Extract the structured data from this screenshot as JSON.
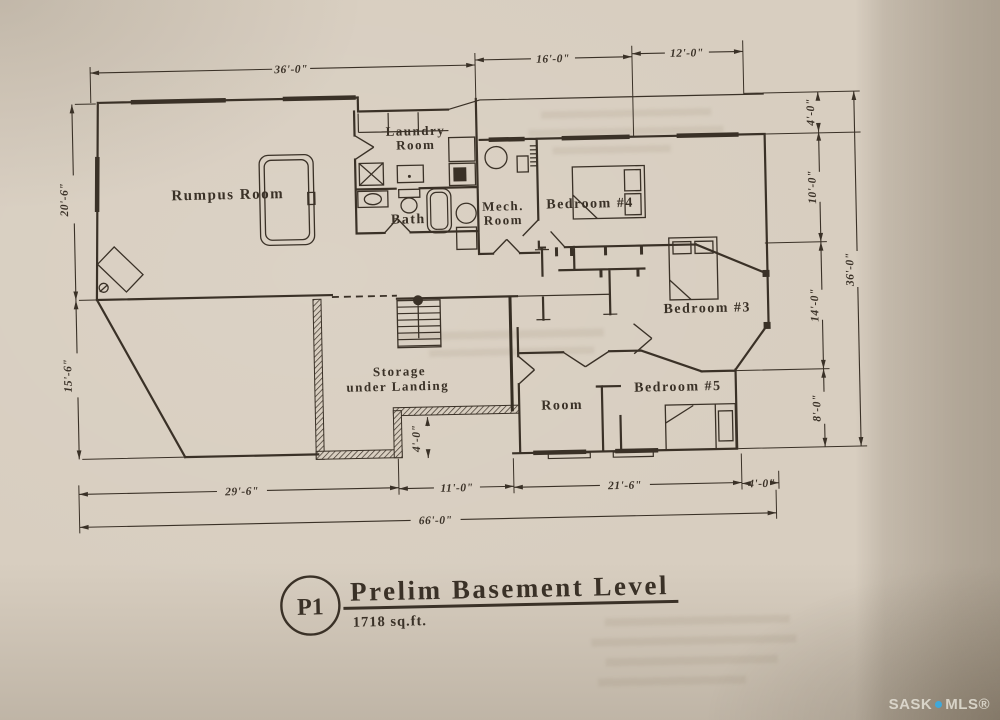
{
  "rooms": {
    "rumpus": "Rumpus Room",
    "laundry_line1": "Laundry",
    "laundry_line2": "Room",
    "bath": "Bath",
    "mech_line1": "Mech.",
    "mech_line2": "Room",
    "bedroom4": "Bedroom #4",
    "bedroom3": "Bedroom #3",
    "bedroom5": "Bedroom #5",
    "room": "Room",
    "storage_line1": "Storage",
    "storage_line2": "under Landing"
  },
  "dimensions": {
    "top": [
      "36'-0\"",
      "16'-0\"",
      "12'-0\""
    ],
    "left": [
      "20'-6\"",
      "15'-6\""
    ],
    "right": [
      "4'-0\"",
      "10'-0\"",
      "14'-0\"",
      "8'-0\"",
      "36'-0\""
    ],
    "bottom": [
      "29'-6\"",
      "11'-0\"",
      "21'-6\"",
      "4'-0\"",
      "66'-0\""
    ],
    "interior": [
      "4'-0\""
    ]
  },
  "title": {
    "tag": "P1",
    "name": "Prelim Basement Level",
    "area": "1718 sq.ft."
  },
  "watermark": {
    "part1": "SASK",
    "part2": "MLS®"
  },
  "colors": {
    "ink": "#3a3127",
    "paper": "#d8cec0",
    "watermark_blue": "#3fa8da"
  }
}
